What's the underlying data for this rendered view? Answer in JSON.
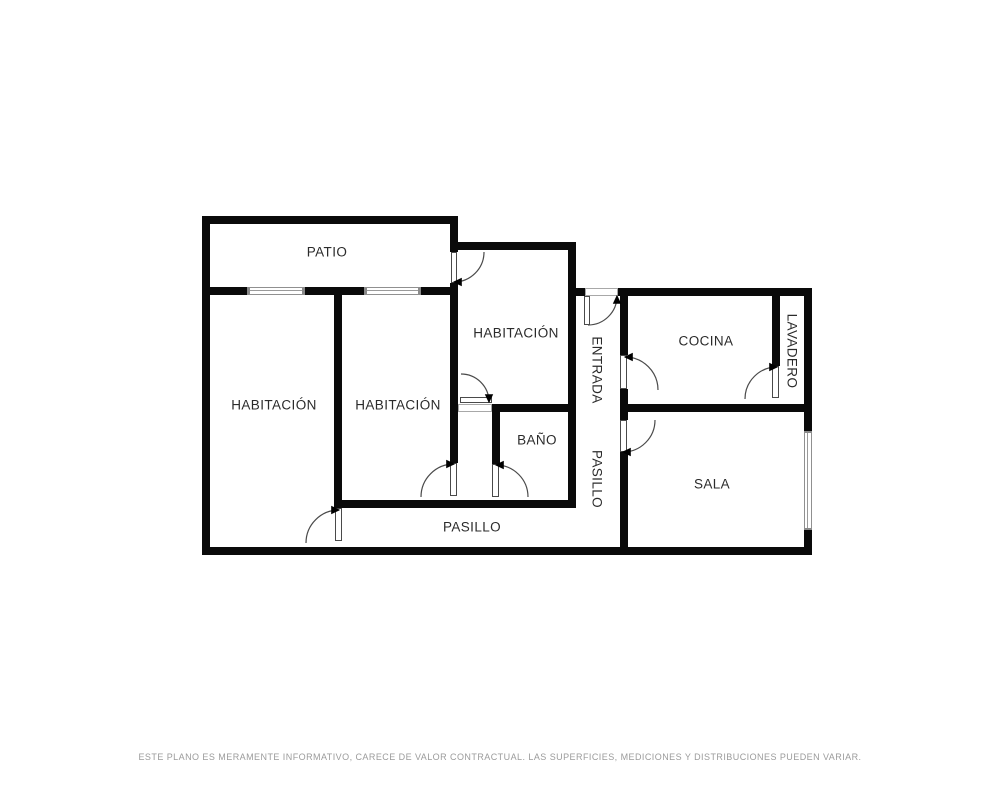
{
  "plan": {
    "rooms": {
      "patio": {
        "label": "PATIO"
      },
      "habitacion_left": {
        "label": "HABITACIÓN"
      },
      "habitacion_middle": {
        "label": "HABITACIÓN"
      },
      "habitacion_top": {
        "label": "HABITACIÓN"
      },
      "entrada": {
        "label": "ENTRADA"
      },
      "cocina": {
        "label": "COCINA"
      },
      "lavadero": {
        "label": "LAVADERO"
      },
      "banio": {
        "label": "BAÑO"
      },
      "pasillo_vertical": {
        "label": "PASILLO"
      },
      "pasillo_horizontal": {
        "label": "PASILLO"
      },
      "sala": {
        "label": "SALA"
      }
    },
    "symbols": {
      "door": "quarter-circle swing arc with leaf and arrowhead",
      "window": "double-line window in wall",
      "opening": "threshold strip in wall"
    },
    "colors": {
      "wall": "#0a0a0a",
      "label": "#2b2b2b",
      "door_stroke": "#4a4a4a",
      "window_stroke": "#909090",
      "disclaimer": "#9b9b9b",
      "background": "#ffffff"
    }
  },
  "footer": {
    "disclaimer": "ESTE PLANO ES MERAMENTE INFORMATIVO, CARECE DE VALOR CONTRACTUAL. LAS SUPERFICIES, MEDICIONES Y DISTRIBUCIONES PUEDEN VARIAR."
  }
}
